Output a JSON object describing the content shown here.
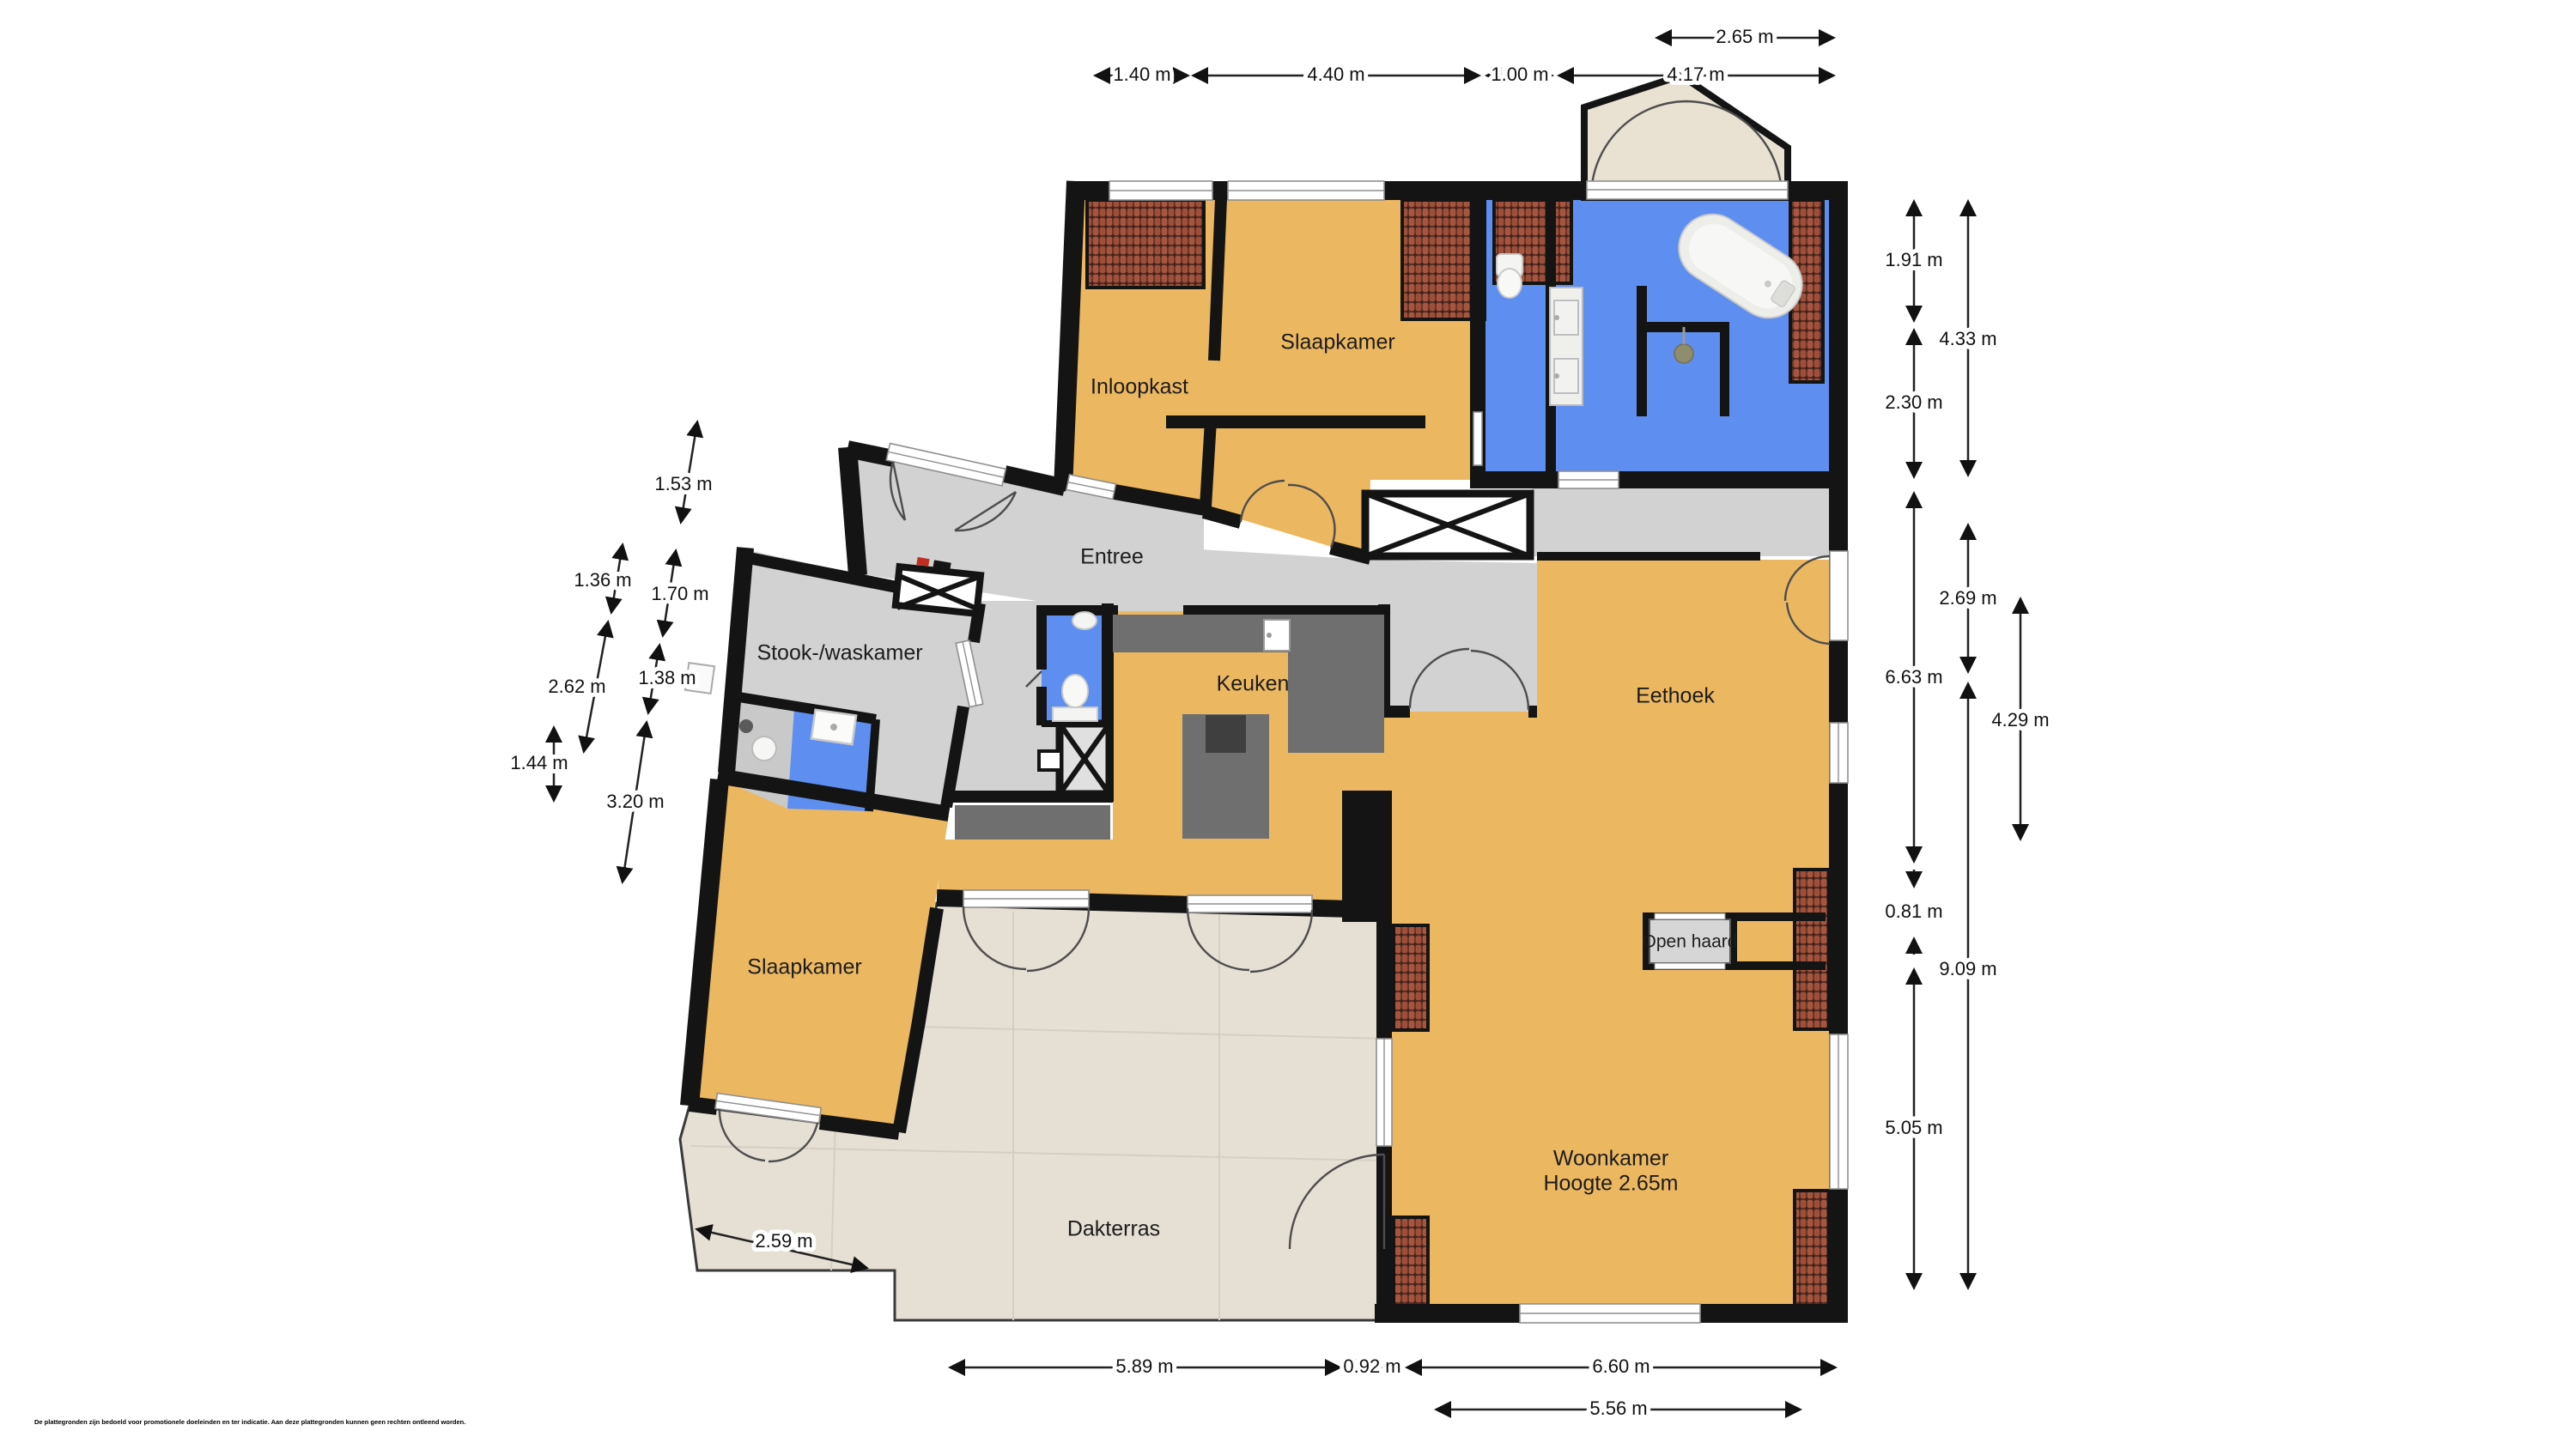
{
  "disclaimer": "De plattegronden zijn bedoeld voor promotionele doeleinden en ter indicatie. Aan deze plattegronden kunnen geen rechten ontleend worden.",
  "palette": {
    "floor_living": "#ECB761",
    "floor_hall": "#D2D2D2",
    "floor_bath": "#5E8FF0",
    "floor_terrace": "#E6DFD4",
    "floor_bay": "#E9E2D3",
    "wall": "#141414",
    "counter": "#6F6F6F",
    "roof_tile": "#9D4F3A",
    "fireplace": "#D6D6D6"
  },
  "labels": {
    "slaapkamer1": "Slaapkamer",
    "inloopkast": "Inloopkast",
    "entree": "Entree",
    "stook_waskamer": "Stook-/waskamer",
    "keuken": "Keuken",
    "eethoek": "Eethoek",
    "open_haard": "Open haard",
    "slaapkamer2": "Slaapkamer",
    "dakterras": "Dakterras",
    "woonkamer": "Woonkamer",
    "woonkamer_hoogte": "Hoogte 2.65m"
  },
  "dims": {
    "top_upper": "2.65 m",
    "top": [
      "1.40 m",
      "4.40 m",
      "1.00 m",
      "4.17 m"
    ],
    "right_col1": [
      "1.91 m",
      "2.30 m",
      "6.63 m",
      "0.81 m",
      "5.05 m"
    ],
    "right_col2": [
      "4.33 m",
      "2.69 m",
      "9.09 m"
    ],
    "right_col3": [
      "4.29 m"
    ],
    "left": [
      "1.53 m",
      "1.36 m",
      "1.70 m",
      "2.62 m",
      "1.38 m",
      "1.44 m",
      "3.20 m"
    ],
    "bottom": [
      "5.89 m",
      "0.92 m",
      "6.60 m"
    ],
    "bottom_row2": [
      "5.56 m"
    ],
    "terrace": [
      "2.59 m"
    ]
  }
}
